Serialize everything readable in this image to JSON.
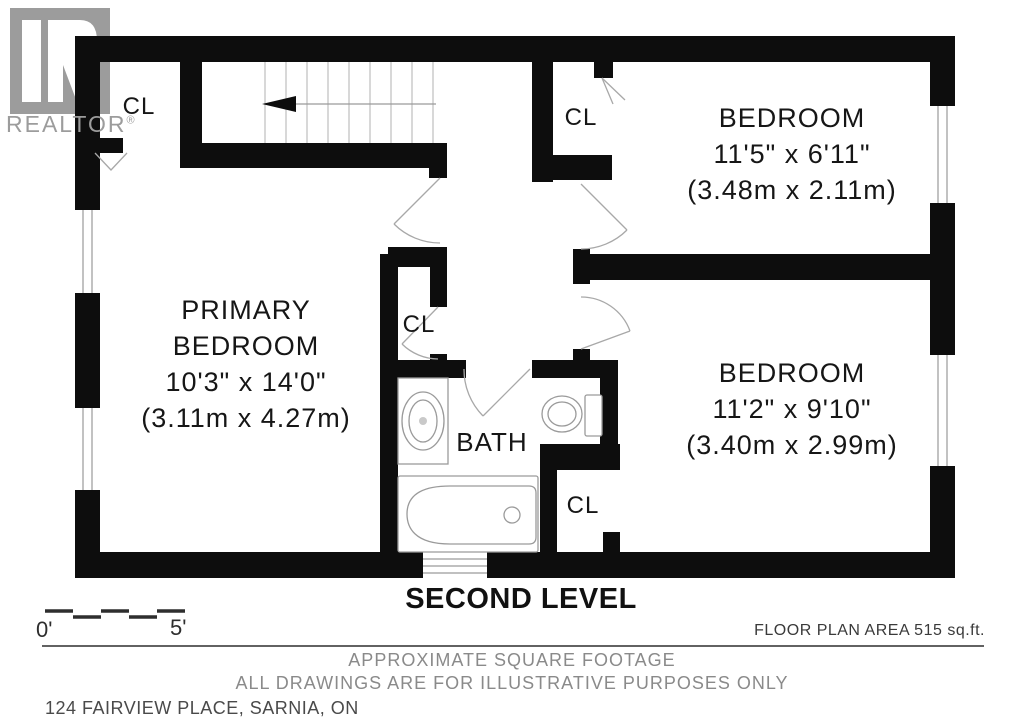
{
  "watermark": {
    "brand": "REALTOR",
    "registered": "®"
  },
  "plan": {
    "closet_labels": [
      "CL",
      "CL",
      "CL",
      "CL"
    ],
    "rooms": {
      "primary": {
        "name_line1": "PRIMARY",
        "name_line2": "BEDROOM",
        "dim_imperial": "10'3\" x 14'0\"",
        "dim_metric": "(3.11m x 4.27m)"
      },
      "bedroom_top": {
        "name": "BEDROOM",
        "dim_imperial": "11'5\" x 6'11\"",
        "dim_metric": "(3.48m x 2.11m)"
      },
      "bedroom_bottom": {
        "name": "BEDROOM",
        "dim_imperial": "11'2\" x 9'10\"",
        "dim_metric": "(3.40m x 2.99m)"
      },
      "bath": {
        "name": "BATH"
      }
    }
  },
  "title": "SECOND LEVEL",
  "scale_bar": {
    "start_label": "0'",
    "end_label": "5'"
  },
  "area_note": "FLOOR PLAN AREA 515 sq.ft.",
  "footer": {
    "line1": "APPROXIMATE SQUARE FOOTAGE",
    "line2": "ALL DRAWINGS ARE FOR ILLUSTRATIVE PURPOSES ONLY",
    "address": "124 FAIRVIEW PLACE, SARNIA, ON"
  },
  "colors": {
    "wall": "#0d0d0d",
    "watermark_gray": "#9c9c9c",
    "door_swing_gray": "#a8a8a8",
    "text_dark": "#1a1a1a",
    "muted_gray": "#8a8a8a"
  }
}
